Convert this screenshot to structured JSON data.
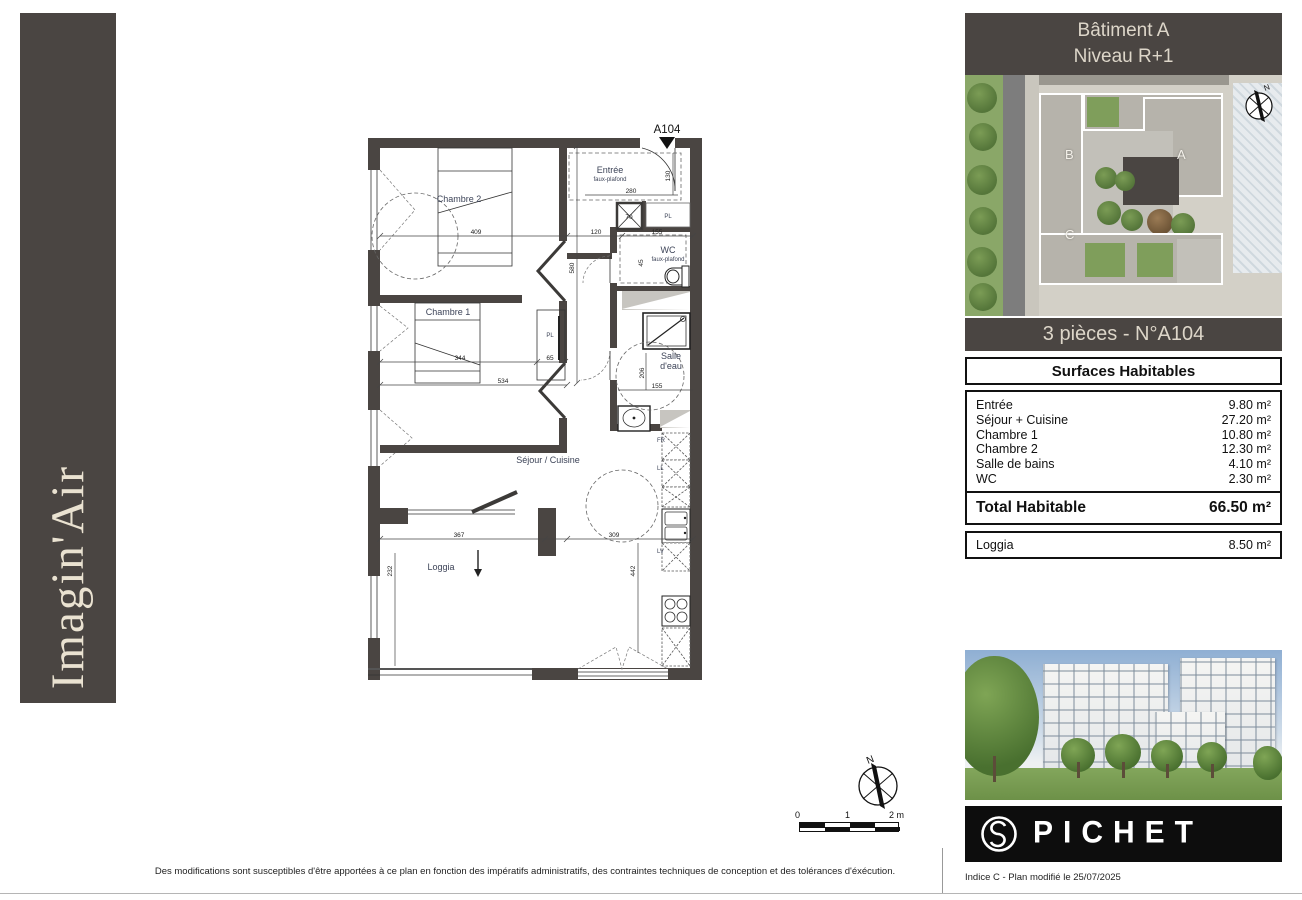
{
  "brand": {
    "vertical_text": "Imagin'Air"
  },
  "header": {
    "line1": "Bâtiment A",
    "line2": "Niveau R+1"
  },
  "site_plan": {
    "building_a": "A",
    "building_b": "B",
    "building_c": "C",
    "compass": "N"
  },
  "unit": {
    "title": "3 pièces - N°A104",
    "surfaces_title": "Surfaces Habitables",
    "rows": [
      {
        "label": "Entrée",
        "value": "9.80 m²"
      },
      {
        "label": "Séjour + Cuisine",
        "value": "27.20 m²"
      },
      {
        "label": "Chambre 1",
        "value": "10.80 m²"
      },
      {
        "label": "Chambre 2",
        "value": "12.30 m²"
      },
      {
        "label": "Salle de bains",
        "value": "4.10 m²"
      },
      {
        "label": "WC",
        "value": "2.30 m²"
      }
    ],
    "total": {
      "label": "Total Habitable",
      "value": "66.50 m²"
    },
    "loggia": {
      "label": "Loggia",
      "value": "8.50 m²"
    }
  },
  "plan": {
    "unit_label": "A104",
    "labels": {
      "entree": "Entrée",
      "faux_plafond": "faux-plafond",
      "pl": "PL",
      "wc": "WC",
      "salle_1": "Salle",
      "salle_2": "d'eau",
      "chambre1": "Chambre 1",
      "chambre2": "Chambre 2",
      "sejour": "Séjour / Cuisine",
      "loggia": "Loggia",
      "fr": "FR",
      "ll": "LL",
      "lv": "LV"
    },
    "dims": {
      "d409": "409",
      "d120": "120",
      "d155a": "155",
      "d280": "280",
      "d130": "130",
      "d580": "580",
      "d70": "70",
      "d45": "45",
      "d344": "344",
      "d65": "65",
      "d534": "534",
      "d206": "206",
      "d155b": "155",
      "d367": "367",
      "d309": "309",
      "d442": "442",
      "d232": "232"
    },
    "compass": "N"
  },
  "scalebar": {
    "t0": "0",
    "t1": "1",
    "t2": "2 m"
  },
  "logo": {
    "word": "PICHET"
  },
  "footer": {
    "disclaimer": "Des modifications sont susceptibles d'être apportées à ce plan en fonction des impératifs administratifs, des contraintes techniques de conception et des tolérances d'éxécution.",
    "note": "Indice C - Plan modifié le 25/07/2025"
  }
}
